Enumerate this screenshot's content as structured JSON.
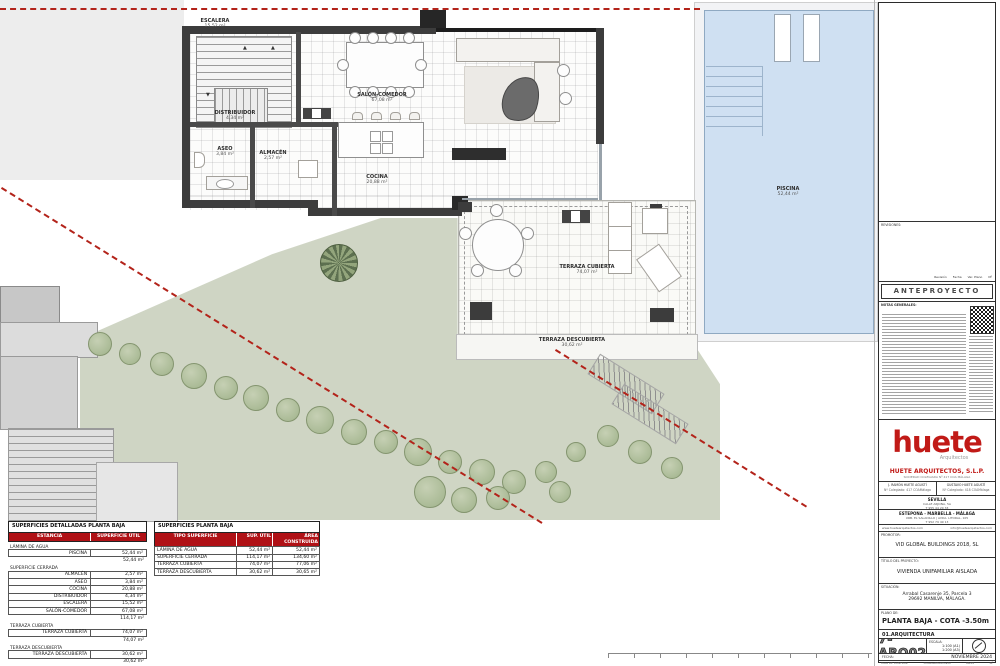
{
  "plan": {
    "rooms": {
      "escalera": {
        "name": "ESCALERA",
        "area": "15,52 m²"
      },
      "distribuidor": {
        "name": "DISTRIBUIDOR",
        "area": "4,34 m²"
      },
      "aseo": {
        "name": "ASEO",
        "area": "3,84 m²"
      },
      "almacen": {
        "name": "ALMACÉN",
        "area": "2,57 m²"
      },
      "salon": {
        "name": "SALÓN-COMEDOR",
        "area": "67,08 m²"
      },
      "cocina": {
        "name": "COCINA",
        "area": "20,88 m²"
      },
      "terraza_cubierta": {
        "name": "TERRAZA CUBIERTA",
        "area": "74,07 m²"
      },
      "terraza_descubierta": {
        "name": "TERRAZA DESCUBIERTA",
        "area": "30,62 m²"
      },
      "piscina": {
        "name": "PISCINA",
        "area": "52,44 m²"
      }
    }
  },
  "tables": {
    "detail": {
      "title": "SUPERFICIES DETALLADAS PLANTA BAJA",
      "col1": "ESTANCIA",
      "col2": "SUPERFICIE ÚTIL",
      "rows": [
        {
          "t": "section",
          "label": "LÁMINA DE AGUA"
        },
        {
          "t": "row",
          "name": "PISCINA",
          "value": "52,44 m²"
        },
        {
          "t": "subtotal",
          "value": "52,44 m²"
        },
        {
          "t": "section",
          "label": "SUPERFICIE CERRADA"
        },
        {
          "t": "row",
          "name": "ALMACÉN",
          "value": "2,57 m²"
        },
        {
          "t": "row",
          "name": "ASEO",
          "value": "3,84 m²"
        },
        {
          "t": "row",
          "name": "COCINA",
          "value": "20,88 m²"
        },
        {
          "t": "row",
          "name": "DISTRIBUIDOR",
          "value": "4,34 m²"
        },
        {
          "t": "row",
          "name": "ESCALERA",
          "value": "15,52 m²"
        },
        {
          "t": "row",
          "name": "SALÓN-COMEDOR",
          "value": "67,08 m²"
        },
        {
          "t": "subtotal",
          "value": "114,17 m²"
        },
        {
          "t": "section",
          "label": "TERRAZA CUBIERTA"
        },
        {
          "t": "row",
          "name": "TERRAZA CUBIERTA",
          "value": "74,07 m²"
        },
        {
          "t": "subtotal",
          "value": "74,07 m²"
        },
        {
          "t": "section",
          "label": "TERRAZA DESCUBIERTA"
        },
        {
          "t": "row",
          "name": "TERRAZA DESCUBIERTA",
          "value": "30,62 m²"
        },
        {
          "t": "subtotal",
          "value": "30,62 m²"
        }
      ]
    },
    "summary": {
      "title": "SUPERFICIES PLANTA BAJA",
      "headers": [
        "TIPO SUPERFICIE",
        "SUP. ÚTIL",
        "ÁREA CONSTRUIDA"
      ],
      "rows": [
        [
          "LÁMINA DE AGUA",
          "52,44 m²",
          "52,44 m²"
        ],
        [
          "SUPERFICIE CERRADA",
          "114,17 m²",
          "134,60 m²"
        ],
        [
          "TERRAZA CUBIERTA",
          "74,07 m²",
          "77,06 m²"
        ],
        [
          "TERRAZA DESCUBIERTA",
          "30,62 m²",
          "30,65 m²"
        ]
      ]
    }
  },
  "titleblock": {
    "revisiones_label": "REVISIONES:",
    "rev_cols": [
      "Revisión",
      "Fecha",
      "Ver. Plano",
      "Nº"
    ],
    "band": "ANTEPROYECTO",
    "notes_label": "NOTAS GENERALES:",
    "logo": {
      "word": "huete",
      "sub": "Arquitectos"
    },
    "firm": "HUETE ARQUITECTOS, S.L.P.",
    "firm_sub": "SOCIEDAD COLEGIADA Nº 417 COA MÁLAGA",
    "architects": [
      {
        "name": "J. RAMÓN HUETE AGUSTÍ",
        "reg": "Nº Colegiado: 417 COAMálaga"
      },
      {
        "name": "GUSTAVO HUETE AGUSTÍ",
        "reg": "Nº Colegiado: 418 COAMálaga"
      }
    ],
    "office1": {
      "city": "SEVILLA",
      "addr": "CALLE ARJONA, 5A",
      "tel": "T 955 44 20 33"
    },
    "office2": {
      "city": "ESTEPONA - MARBELLA - MÁLAGA",
      "addr": "URB. EL SALADILLO | AVDA. LITORAL, 105",
      "tel": "T 952 79 49 13"
    },
    "web": "www.huetearquitectos.com",
    "email": "info@huetearquitectos.com",
    "promotor_label": "PROMOTOR:",
    "promotor": "VID GLOBAL BUILDINGS 2018, SL",
    "titulo_label": "TÍTULO DEL PROYECTO:",
    "titulo": "VIVIENDA UNIFAMILIAR AISLADA",
    "situacion_label": "SITUACIÓN:",
    "situacion1": "Arrabal Casarenje 35, Parcela 3",
    "situacion2": "29692 MANILVA, MÁLAGA.",
    "plano_label": "PLANO DE:",
    "plano": "PLANTA BAJA - COTA -3.50m",
    "discipline": "01.ARQUITECTURA",
    "code": "7-ARQ02",
    "escala_label": "ESCALA:",
    "escala1": "1:100 (A1)",
    "escala2": "1:200 (A3)",
    "fecha_label": "FECHA:",
    "fecha": "NOVIEMBRE 2024",
    "control": [
      "HOJA DE CONTROL:",
      "Original/Modificado",
      "06/05",
      "Nº"
    ]
  }
}
